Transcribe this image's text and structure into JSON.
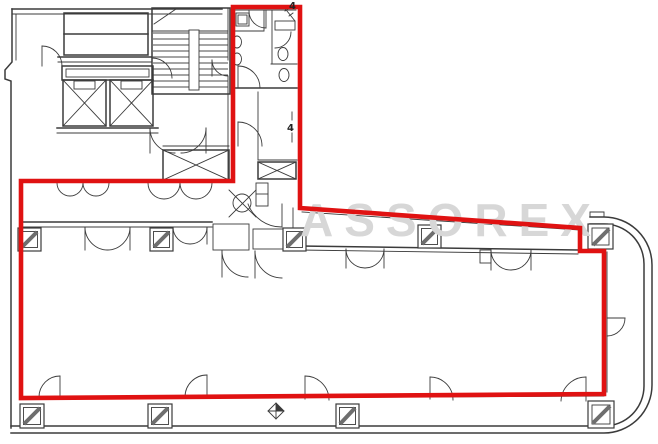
{
  "document": {
    "type": "architectural-floor-plan",
    "description": "Office building floor plan; leased L-shaped area outlined in red, common core (stairs, elevators, lavatories) at upper left"
  },
  "colors": {
    "paper": "#ffffff",
    "ink": "#3b3b3b",
    "ink_soft": "#6e6e6e",
    "red": "#e01212",
    "watermark": "#d7d7d7"
  },
  "watermark": {
    "text": "ASSOREX"
  },
  "labels": {
    "grid_marker_top": "4",
    "grid_marker_mid": "4"
  }
}
